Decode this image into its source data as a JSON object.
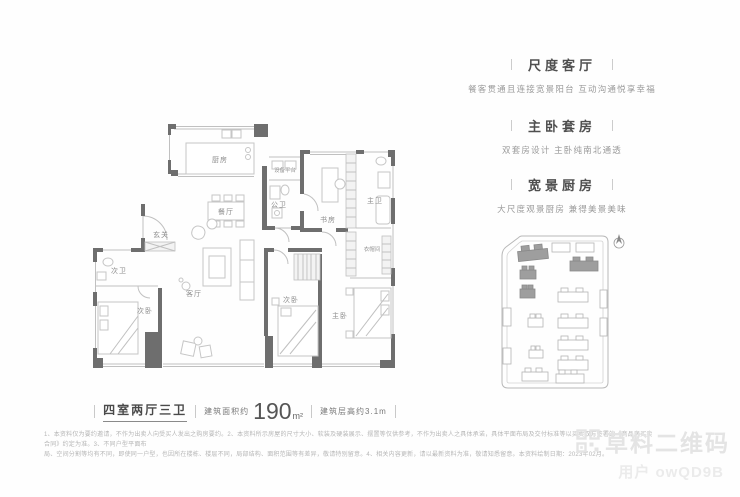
{
  "colors": {
    "wall": "#6e6e6e",
    "thin_line": "#c0c0c0",
    "room_label": "#8c8c8c",
    "title": "#4f4f4f",
    "description": "#9a9a9a",
    "disclaimer": "#b6b6b6",
    "watermark": "#e4e4e4"
  },
  "floorplan": {
    "rooms": [
      {
        "label": "厨房"
      },
      {
        "label": "设备平台"
      },
      {
        "label": "餐厅"
      },
      {
        "label": "公卫"
      },
      {
        "label": "书房"
      },
      {
        "label": "主卫"
      },
      {
        "label": "玄关"
      },
      {
        "label": "次卫"
      },
      {
        "label": "次卧"
      },
      {
        "label": "客厅"
      },
      {
        "label": "次卧"
      },
      {
        "label": "主卧"
      },
      {
        "label": "衣帽间"
      }
    ]
  },
  "features": [
    {
      "title": "尺度客厅",
      "desc": "餐客贯通且连接宽景阳台  互动沟通悦享幸福"
    },
    {
      "title": "主卧套房",
      "desc": "双套房设计  主卧纯南北通透"
    },
    {
      "title": "宽景厨房",
      "desc": "大尺度观景厨房  兼得美景美味"
    }
  ],
  "summary": {
    "layout": "四室两厅三卫",
    "area_label": "建筑面积约",
    "area_value": "190",
    "area_unit": "m²",
    "floor_height": "建筑层高约3.1m"
  },
  "disclaimer": {
    "line1": "1、本资料仅为要约邀请，不作为出卖人向受买人发出之购房要约。2、本资料所示房屋的尺寸大小、软装及硬装展示、摆置等仅供参考，不作为出卖人之具体承诺，具体平面布局及交付标准等以买卖双方签署的《商品房买卖合同》约定为准。3、不同户型平面布",
    "line2": "局、空间分割等均有不同，即使同一户型，也因所在楼栋、楼层不同，局部结构、面积范围等有差异，敬请特别留意。4、相关内容更新，请以最新资料为准，敬请知悉留意。本资料绘制日期：2023年02月。"
  },
  "watermark": {
    "brand": "草料二维码",
    "user": "用户 owQD9B"
  }
}
